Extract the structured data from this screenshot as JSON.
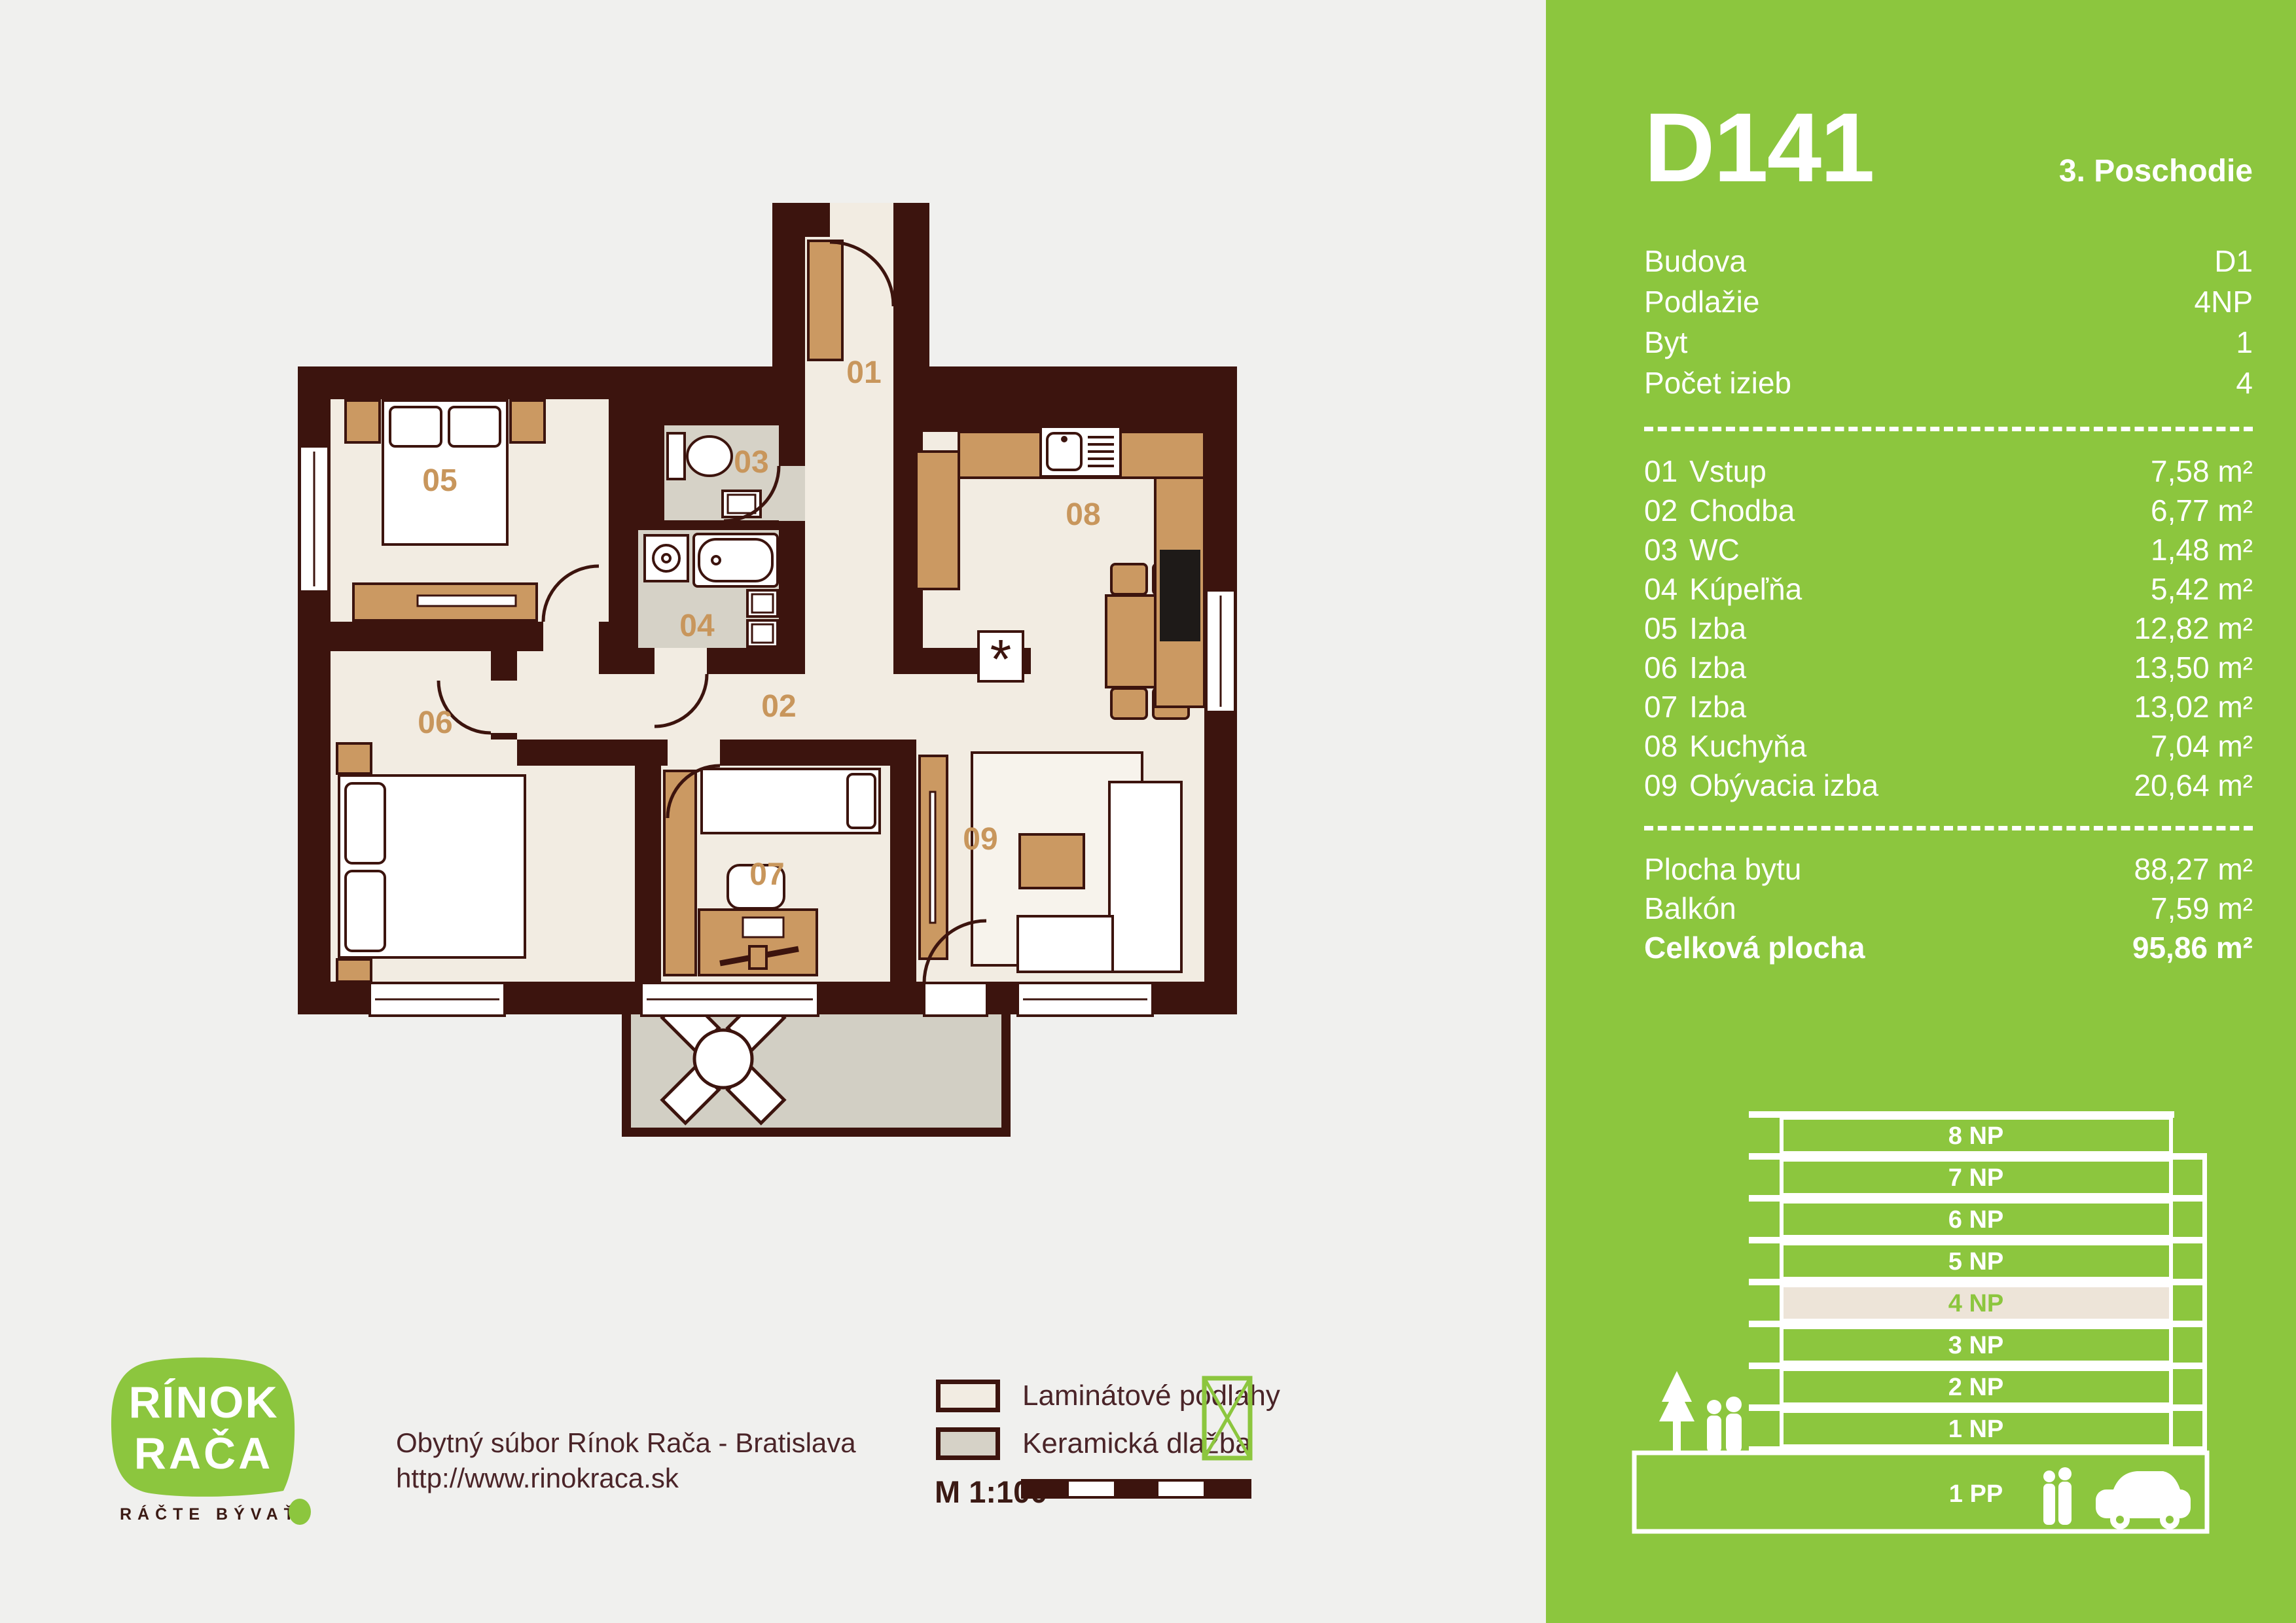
{
  "colors": {
    "green": "#8CC63E",
    "wall_brown": "#3C140E",
    "laminate": "#F2ECE2",
    "ceramic": "#D6D2C7",
    "furniture_tan": "#CB9962",
    "plan_label_tan": "#C8965C",
    "background": "#F0F0EE",
    "floor_highlight": "#EDE4D8"
  },
  "brand": {
    "logo_line1": "RÍNOK",
    "logo_line2": "RAČA",
    "tagline": "RÁČTE BÝVAŤ"
  },
  "footer": {
    "project_line": "Obytný súbor Rínok Rača - Bratislava",
    "website": "http://www.rinokraca.sk"
  },
  "legend": {
    "items": [
      {
        "label": "Laminátové podlahy",
        "swatch": "#F2ECE2"
      },
      {
        "label": "Keramická dlažba",
        "swatch": "#D6D2C7"
      }
    ],
    "scale_label": "M 1:100"
  },
  "panel": {
    "title": "D141",
    "subtitle": "3. Poschodie",
    "info": [
      {
        "label": "Budova",
        "value": "D1"
      },
      {
        "label": "Podlažie",
        "value": "4NP"
      },
      {
        "label": "Byt",
        "value": "1"
      },
      {
        "label": "Počet izieb",
        "value": "4"
      }
    ],
    "rooms": [
      {
        "code": "01",
        "name": "Vstup",
        "area": "7,58 m²"
      },
      {
        "code": "02",
        "name": "Chodba",
        "area": "6,77 m²"
      },
      {
        "code": "03",
        "name": "WC",
        "area": "1,48 m²"
      },
      {
        "code": "04",
        "name": "Kúpeľňa",
        "area": "5,42 m²"
      },
      {
        "code": "05",
        "name": "Izba",
        "area": "12,82 m²"
      },
      {
        "code": "06",
        "name": "Izba",
        "area": "13,50 m²"
      },
      {
        "code": "07",
        "name": "Izba",
        "area": "13,02 m²"
      },
      {
        "code": "08",
        "name": "Kuchyňa",
        "area": "7,04 m²"
      },
      {
        "code": "09",
        "name": "Obývacia izba",
        "area": "20,64 m²"
      }
    ],
    "totals": [
      {
        "label": "Plocha bytu",
        "value": "88,27 m²"
      },
      {
        "label": "Balkón",
        "value": "7,59 m²"
      },
      {
        "label": "Celková plocha",
        "value": "95,86 m²"
      }
    ]
  },
  "building": {
    "floors": [
      {
        "label": "8 NP"
      },
      {
        "label": "7 NP"
      },
      {
        "label": "6 NP"
      },
      {
        "label": "5 NP"
      },
      {
        "label": "4 NP"
      },
      {
        "label": "3 NP"
      },
      {
        "label": "2 NP"
      },
      {
        "label": "1 NP"
      },
      {
        "label": "1 PP"
      }
    ],
    "highlighted_floor": "4 NP"
  },
  "plan": {
    "room_labels": [
      "01",
      "02",
      "03",
      "04",
      "05",
      "06",
      "07",
      "08",
      "09"
    ],
    "boiler_symbol": "*"
  }
}
